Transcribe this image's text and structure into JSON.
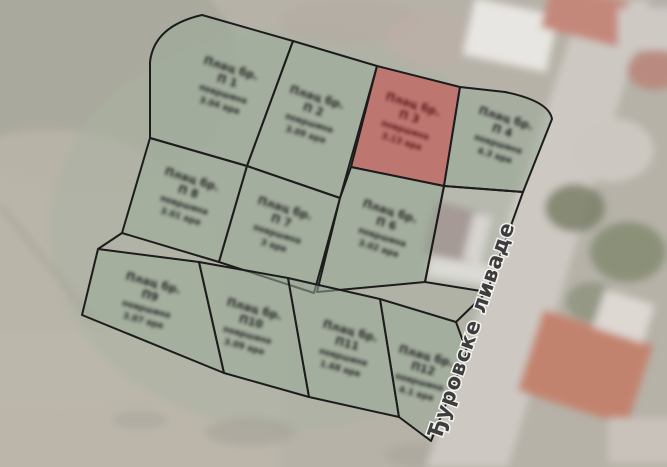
{
  "map": {
    "road_label": "Ђуровске ливаде"
  },
  "plots": [
    {
      "title": "Плац бр.",
      "number": "П 1",
      "area_caption": "површина",
      "area": "3.04 ара",
      "highlighted": false
    },
    {
      "title": "Плац бр.",
      "number": "П 2",
      "area_caption": "површина",
      "area": "3.09 ара",
      "highlighted": false
    },
    {
      "title": "Плац бр.",
      "number": "П 3",
      "area_caption": "површина",
      "area": "3.13 ара",
      "highlighted": true
    },
    {
      "title": "Плац бр.",
      "number": "П 4",
      "area_caption": "површина",
      "area": "4.3 ара",
      "highlighted": false
    },
    {
      "title": "Плац бр.",
      "number": "П 8",
      "area_caption": "површина",
      "area": "3.01 ара",
      "highlighted": false
    },
    {
      "title": "Плац бр.",
      "number": "П 7",
      "area_caption": "површина",
      "area": "3 ара",
      "highlighted": false
    },
    {
      "title": "Плац бр.",
      "number": "П 6",
      "area_caption": "површина",
      "area": "3.02 ара",
      "highlighted": false
    },
    {
      "title": "Плац бр.",
      "number": "П9",
      "area_caption": "површина",
      "area": "3.07 ара",
      "highlighted": false
    },
    {
      "title": "Плац бр.",
      "number": "П10",
      "area_caption": "површина",
      "area": "3.09 ара",
      "highlighted": false
    },
    {
      "title": "Плац бр.",
      "number": "П11",
      "area_caption": "површина",
      "area": "1.68 ара",
      "highlighted": false
    },
    {
      "title": "Плац бр.",
      "number": "П12",
      "area_caption": "површина",
      "area": "4.1 ара",
      "highlighted": false
    }
  ],
  "colors": {
    "plot_fill": "rgba(154,172,153,0.55)",
    "plot_highlight_fill": "rgba(200,80,80,0.62)",
    "plot_stroke": "#1c1c1c",
    "label_ink": "#272727",
    "highlight_label_ink": "#5f1a1a",
    "road_fill": "#cdc9c2",
    "road_label_ink": "#3d3d3d"
  }
}
